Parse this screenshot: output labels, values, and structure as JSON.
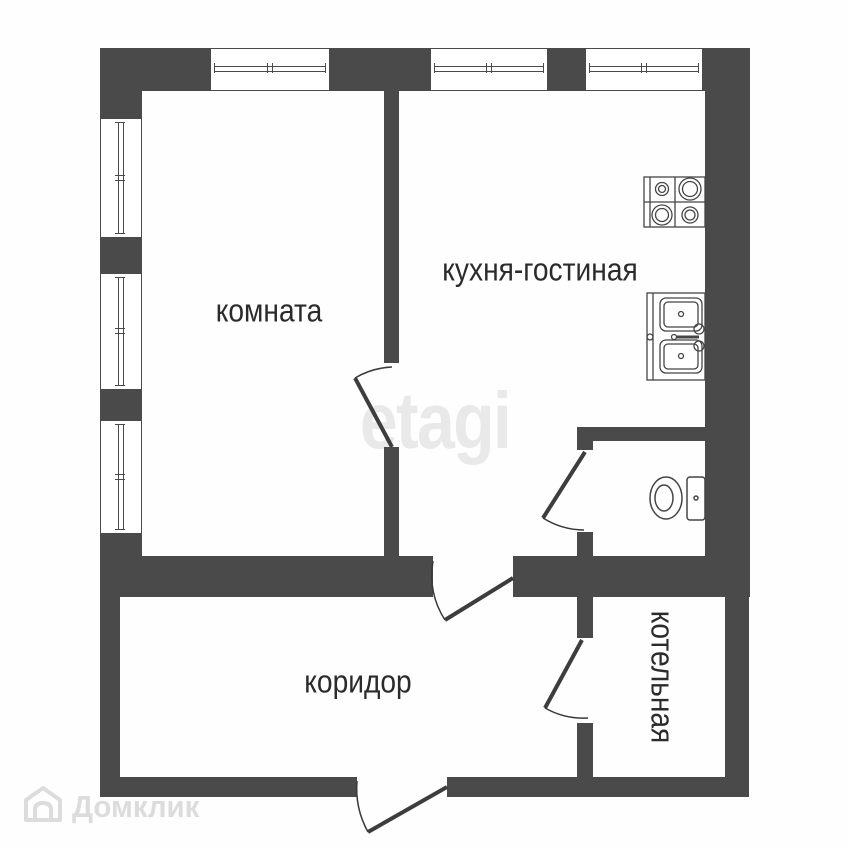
{
  "plan": {
    "rooms": [
      {
        "id": "komnata",
        "label": "комната"
      },
      {
        "id": "kitchen-living",
        "label": "кухня-гостиная"
      },
      {
        "id": "corridor",
        "label": "коридор"
      },
      {
        "id": "boiler",
        "label": "котельная"
      }
    ],
    "fixtures": [
      "stove-icon",
      "sink-icon",
      "toilet-icon"
    ],
    "window_count": 6,
    "door_count": 5
  },
  "watermarks": {
    "etagi": "etagi",
    "domclick": "Домклик"
  },
  "colors": {
    "wall": "#4a4a4a",
    "label": "#2b2b2b",
    "watermark_etagi": "#e9e9e9",
    "watermark_domclick": "#dcdcdc"
  }
}
